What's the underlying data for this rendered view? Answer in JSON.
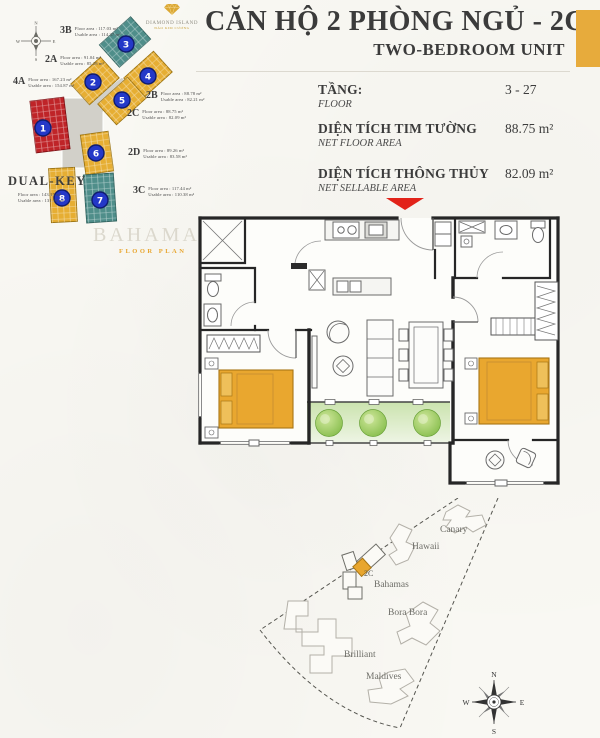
{
  "header": {
    "title": "CĂN HỘ 2 PHÒNG NGỦ - 2C",
    "subtitle": "TWO-BEDROOM UNIT"
  },
  "info": {
    "rows": [
      {
        "label_vi": "TẦNG:",
        "label_en": "FLOOR",
        "value": "3 - 27"
      },
      {
        "label_vi": "DIỆN TÍCH TIM TƯỜNG",
        "label_en": "NET FLOOR AREA",
        "value": "88.75 m²"
      },
      {
        "label_vi": "DIỆN TÍCH THÔNG THỦY",
        "label_en": "NET SELLABLE AREA",
        "value": "82.09 m²"
      }
    ]
  },
  "brand": {
    "name": "DIAMOND ISLAND",
    "tagline": "ĐẢO KIM CƯƠNG"
  },
  "key_plan": {
    "watermark": {
      "line1": "BAHAMAS",
      "line2": "FLOOR PLAN"
    },
    "compass": {
      "n": "N",
      "e": "E",
      "s": "S",
      "w": "W"
    },
    "units": [
      {
        "name": "4A",
        "number": "1",
        "floor_area": "Floor area : 167.23 m²",
        "usable_area": "Usable area : 154.87 m²"
      },
      {
        "name": "2A",
        "number": "2",
        "floor_area": "Floor area : 91.04 m²",
        "usable_area": "Usable area : 85.28 m²"
      },
      {
        "name": "3B",
        "number": "3",
        "floor_area": "Floor area : 117.03 m²",
        "usable_area": "Usable area : 114.37 m²"
      },
      {
        "name": "2B",
        "number": "4",
        "floor_area": "Floor area : 88.78 m²",
        "usable_area": "Usable area : 82.21 m²"
      },
      {
        "name": "2C",
        "number": "5",
        "floor_area": "Floor area : 88.75 m²",
        "usable_area": "Usable area : 82.09 m²"
      },
      {
        "name": "2D",
        "number": "6",
        "floor_area": "Floor area : 89.26 m²",
        "usable_area": "Usable area : 83.58 m²"
      },
      {
        "name": "3C",
        "number": "7",
        "floor_area": "Floor area : 117.44 m²",
        "usable_area": "Usable area : 110.38 m²"
      },
      {
        "name": "DUAL-KEY",
        "number": "8",
        "floor_area": "Floor area : 143.15 m²",
        "usable_area": "Usable area : 131.32 m²"
      }
    ]
  },
  "site_map": {
    "unit_marker": "2C",
    "towers": [
      "Canary",
      "Hawaii",
      "Bahamas",
      "Bora Bora",
      "Brilliant",
      "Maldives"
    ],
    "compass": {
      "n": "N",
      "e": "E",
      "s": "S",
      "w": "W"
    }
  },
  "colors": {
    "accent_gold": "#e7ab3c",
    "unit_yellow": "#e6ae33",
    "unit_teal": "#4f8e8a",
    "unit_red": "#bf2428",
    "badge_blue": "#2438c8",
    "arrow_red": "#e2231a",
    "plant_green": "#7fb944"
  }
}
